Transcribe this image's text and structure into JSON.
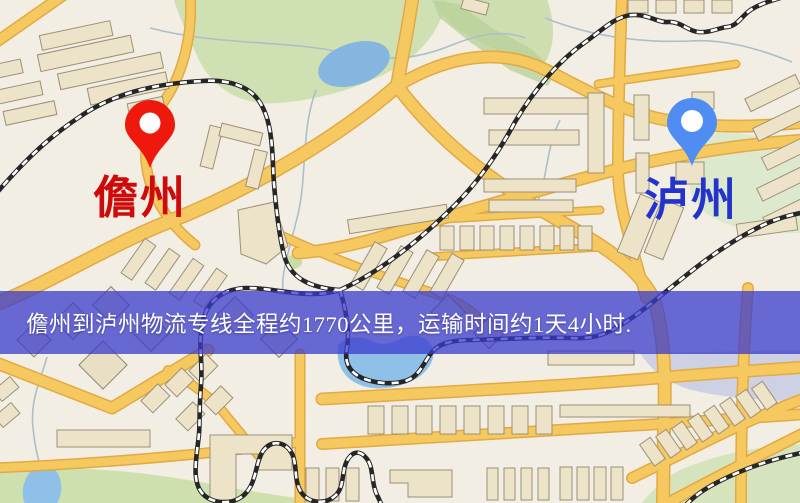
{
  "page": {
    "width_px": 800,
    "height_px": 503,
    "kind": "logistics-route-map"
  },
  "map": {
    "origin": {
      "label": "儋州",
      "pin_color": "#ee180c",
      "label_color": "#cf0a0a"
    },
    "destination": {
      "label": "泸州",
      "pin_color": "#4f8df2",
      "label_color": "#2334cb"
    },
    "banner": {
      "text": "儋州到泸州物流专线全程约1770公里，运输时间约1天4小时.",
      "distance_km": "1770",
      "duration": "1天4小时",
      "background_color": "rgba(57,59,205,0.75)",
      "text_color": "#ffffff"
    },
    "palette": {
      "map_background": "#f2eee3",
      "road_fill": "#f5c95f",
      "road_casing": "#e2a944",
      "park_green": "#cfe1b2",
      "water_blue": "#86b7e0",
      "railway_dark": "#262626",
      "building_fill": "#ece3c9"
    }
  }
}
